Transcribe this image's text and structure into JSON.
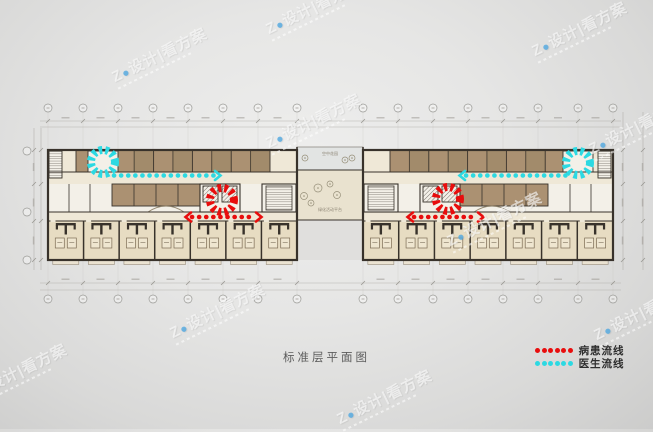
{
  "title": "标准层平面图",
  "legend": {
    "items": [
      {
        "id": "patient-flow",
        "label": "病患流线",
        "color": "#e80d0d",
        "dots": 6
      },
      {
        "id": "doctor-flow",
        "label": "医生流线",
        "color": "#2cd9e2",
        "dots": 6
      }
    ]
  },
  "watermark": {
    "text_prefix": "Z",
    "logo_glyph": "●",
    "text_suffix": "设计|看方案",
    "instances": [
      {
        "x": 108,
        "y": 68
      },
      {
        "x": 262,
        "y": 20
      },
      {
        "x": 528,
        "y": 42
      },
      {
        "x": 262,
        "y": 134
      },
      {
        "x": 585,
        "y": 140
      },
      {
        "x": 443,
        "y": 232
      },
      {
        "x": 166,
        "y": 324
      },
      {
        "x": 590,
        "y": 326
      },
      {
        "x": 333,
        "y": 410
      },
      {
        "x": -32,
        "y": 384
      }
    ]
  },
  "plan": {
    "colors": {
      "wall": "#38322b",
      "roomBrown": "#ab9172",
      "roomBrownDark": "#93805f",
      "cream": "#efe8d7",
      "patient": "#e7dcc2",
      "white": "#f3f0e8",
      "terrace": "#e2e4e3",
      "atrium": "#e9e2cf",
      "courtyard": "#dedddb",
      "hatch": "#5a544c",
      "bed": "#efe6d0",
      "bedStroke": "#7c6c54",
      "dim": "#a9a7a2",
      "gridline": "#c4c2be",
      "bubble": "#9a9a96",
      "tree": "#97907a",
      "label": "#8c8474"
    },
    "bands": {
      "top": 150,
      "topRoomsBottom": 172,
      "corridorBottom": 184,
      "midRoomsBottom": 206,
      "midBottom": 212,
      "lowerCorridorBottom": 221,
      "bottom": 260
    },
    "wings": {
      "left": {
        "x0": 48,
        "x1": 297,
        "topBrown": [
          76,
          270
        ],
        "stairTopHatch": [
          49,
          62
        ],
        "burstRoom": [
          88,
          118
        ],
        "midBrown": [
          112,
          200
        ],
        "core": [
          200,
          240
        ],
        "stairMid": [
          262,
          296
        ],
        "midWhiteDividers": [
          69,
          90
        ],
        "arcCx": 166
      },
      "right": {
        "x0": 363,
        "x1": 613,
        "topBrown": [
          390,
          584
        ],
        "stairTopHatch": [
          598,
          611
        ],
        "burstRoom": [
          563,
          593
        ],
        "midBrown": [
          460,
          548
        ],
        "core": [
          420,
          460
        ],
        "stairMid": [
          364,
          398
        ],
        "midWhiteDividers": [
          570,
          591
        ],
        "arcCx": 492
      }
    },
    "topRoomCount": 10,
    "patientModuleCount": 7,
    "connector": {
      "x0": 297,
      "x1": 363,
      "terraceTop": 147,
      "terraceBottom": 170,
      "atriumBottom": 220,
      "terraceLabel": "空中花园",
      "label": "绿化活动平台",
      "trees": [
        [
          318,
          188,
          4
        ],
        [
          304,
          196,
          3.5
        ],
        [
          311,
          203,
          3
        ],
        [
          337,
          195,
          3.5
        ],
        [
          330,
          184,
          3
        ],
        [
          345,
          160,
          3
        ],
        [
          305,
          158,
          3
        ],
        [
          352,
          158,
          3
        ]
      ]
    },
    "grid": {
      "xsLeft": [
        48,
        83,
        118,
        153,
        188,
        223,
        258,
        297
      ],
      "xsRight": [
        363,
        398,
        433,
        468,
        503,
        538,
        578,
        613
      ],
      "bubbleTopY": 108,
      "topDimY": 121,
      "topDimY2": 127,
      "botDimY": 283,
      "botDimY2": 290,
      "bubbleBotY": 299,
      "leftSideX": [
        34,
        41
      ],
      "rightSideX": [
        623,
        643
      ],
      "sideYs": [
        150,
        184,
        221,
        260
      ],
      "leftBubbles": [
        151,
        212,
        260
      ]
    },
    "flows": {
      "doctor": {
        "color": "#2cd9e2",
        "bursts": [
          {
            "cx": 103,
            "cy": 162,
            "r": 12
          },
          {
            "cx": 578,
            "cy": 163,
            "r": 12
          }
        ],
        "lines": [
          {
            "x1": 114,
            "y1": 175.5,
            "x2": 214,
            "y2": 175.5,
            "arrowStart": false,
            "arrowEnd": true
          },
          {
            "x1": 466,
            "y1": 175.5,
            "x2": 566,
            "y2": 175.5,
            "arrowStart": true,
            "arrowEnd": false
          }
        ]
      },
      "patient": {
        "color": "#e80d0d",
        "bursts": [
          {
            "cx": 222,
            "cy": 200,
            "r": 12
          },
          {
            "cx": 448,
            "cy": 199,
            "r": 12
          }
        ],
        "lines": [
          {
            "x1": 192,
            "y1": 217,
            "x2": 255,
            "y2": 217,
            "arrowStart": true,
            "arrowEnd": true
          },
          {
            "x1": 414,
            "y1": 217,
            "x2": 477,
            "y2": 217,
            "arrowStart": true,
            "arrowEnd": true
          }
        ]
      }
    }
  }
}
